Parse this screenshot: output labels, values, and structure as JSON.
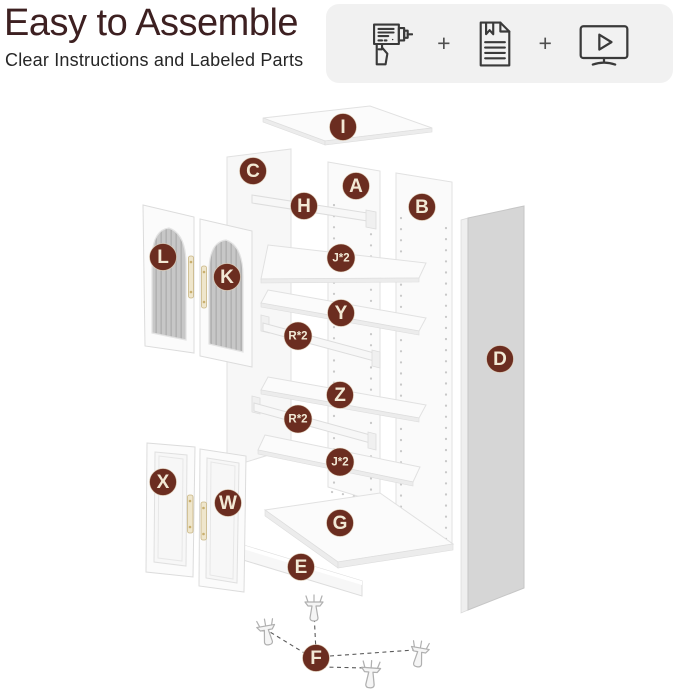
{
  "header": {
    "title": "Easy to Assemble",
    "subtitle": "Clear Instructions and Labeled Parts",
    "separators": [
      "+",
      "+"
    ],
    "icons": [
      "drill-icon",
      "instruction-manual-icon",
      "video-tutorial-icon"
    ]
  },
  "colors": {
    "title_text": "#3d2021",
    "subtitle_text": "#262626",
    "icon_panel_bg": "#f1f1f1",
    "icon_stroke": "#3a3a3a",
    "part_label_bg": "#6b2d20",
    "part_label_ring": "#e8dcc4",
    "part_label_text": "#f2e9d5"
  },
  "diagram": {
    "parts": [
      {
        "id": "i",
        "label": "I",
        "x": 343,
        "y": 127,
        "small": false
      },
      {
        "id": "c",
        "label": "C",
        "x": 253,
        "y": 171,
        "small": false
      },
      {
        "id": "a",
        "label": "A",
        "x": 356,
        "y": 186,
        "small": false
      },
      {
        "id": "b",
        "label": "B",
        "x": 422,
        "y": 207,
        "small": false
      },
      {
        "id": "h",
        "label": "H",
        "x": 304,
        "y": 206,
        "small": false
      },
      {
        "id": "l",
        "label": "L",
        "x": 163,
        "y": 257,
        "small": false
      },
      {
        "id": "k",
        "label": "K",
        "x": 227,
        "y": 277,
        "small": false
      },
      {
        "id": "j2-upper",
        "label": "J*2",
        "x": 341,
        "y": 258,
        "small": true
      },
      {
        "id": "y",
        "label": "Y",
        "x": 341,
        "y": 313,
        "small": false
      },
      {
        "id": "r2-upper",
        "label": "R*2",
        "x": 298,
        "y": 336,
        "small": true
      },
      {
        "id": "z",
        "label": "Z",
        "x": 340,
        "y": 395,
        "small": false
      },
      {
        "id": "r2-lower",
        "label": "R*2",
        "x": 298,
        "y": 419,
        "small": true
      },
      {
        "id": "j2-lower",
        "label": "J*2",
        "x": 340,
        "y": 462,
        "small": true
      },
      {
        "id": "d",
        "label": "D",
        "x": 500,
        "y": 359,
        "small": false
      },
      {
        "id": "x",
        "label": "X",
        "x": 163,
        "y": 482,
        "small": false
      },
      {
        "id": "w",
        "label": "W",
        "x": 228,
        "y": 503,
        "small": false
      },
      {
        "id": "g",
        "label": "G",
        "x": 340,
        "y": 523,
        "small": false
      },
      {
        "id": "e",
        "label": "E",
        "x": 301,
        "y": 567,
        "small": false
      },
      {
        "id": "f",
        "label": "F",
        "x": 316,
        "y": 658,
        "small": false
      }
    ]
  }
}
